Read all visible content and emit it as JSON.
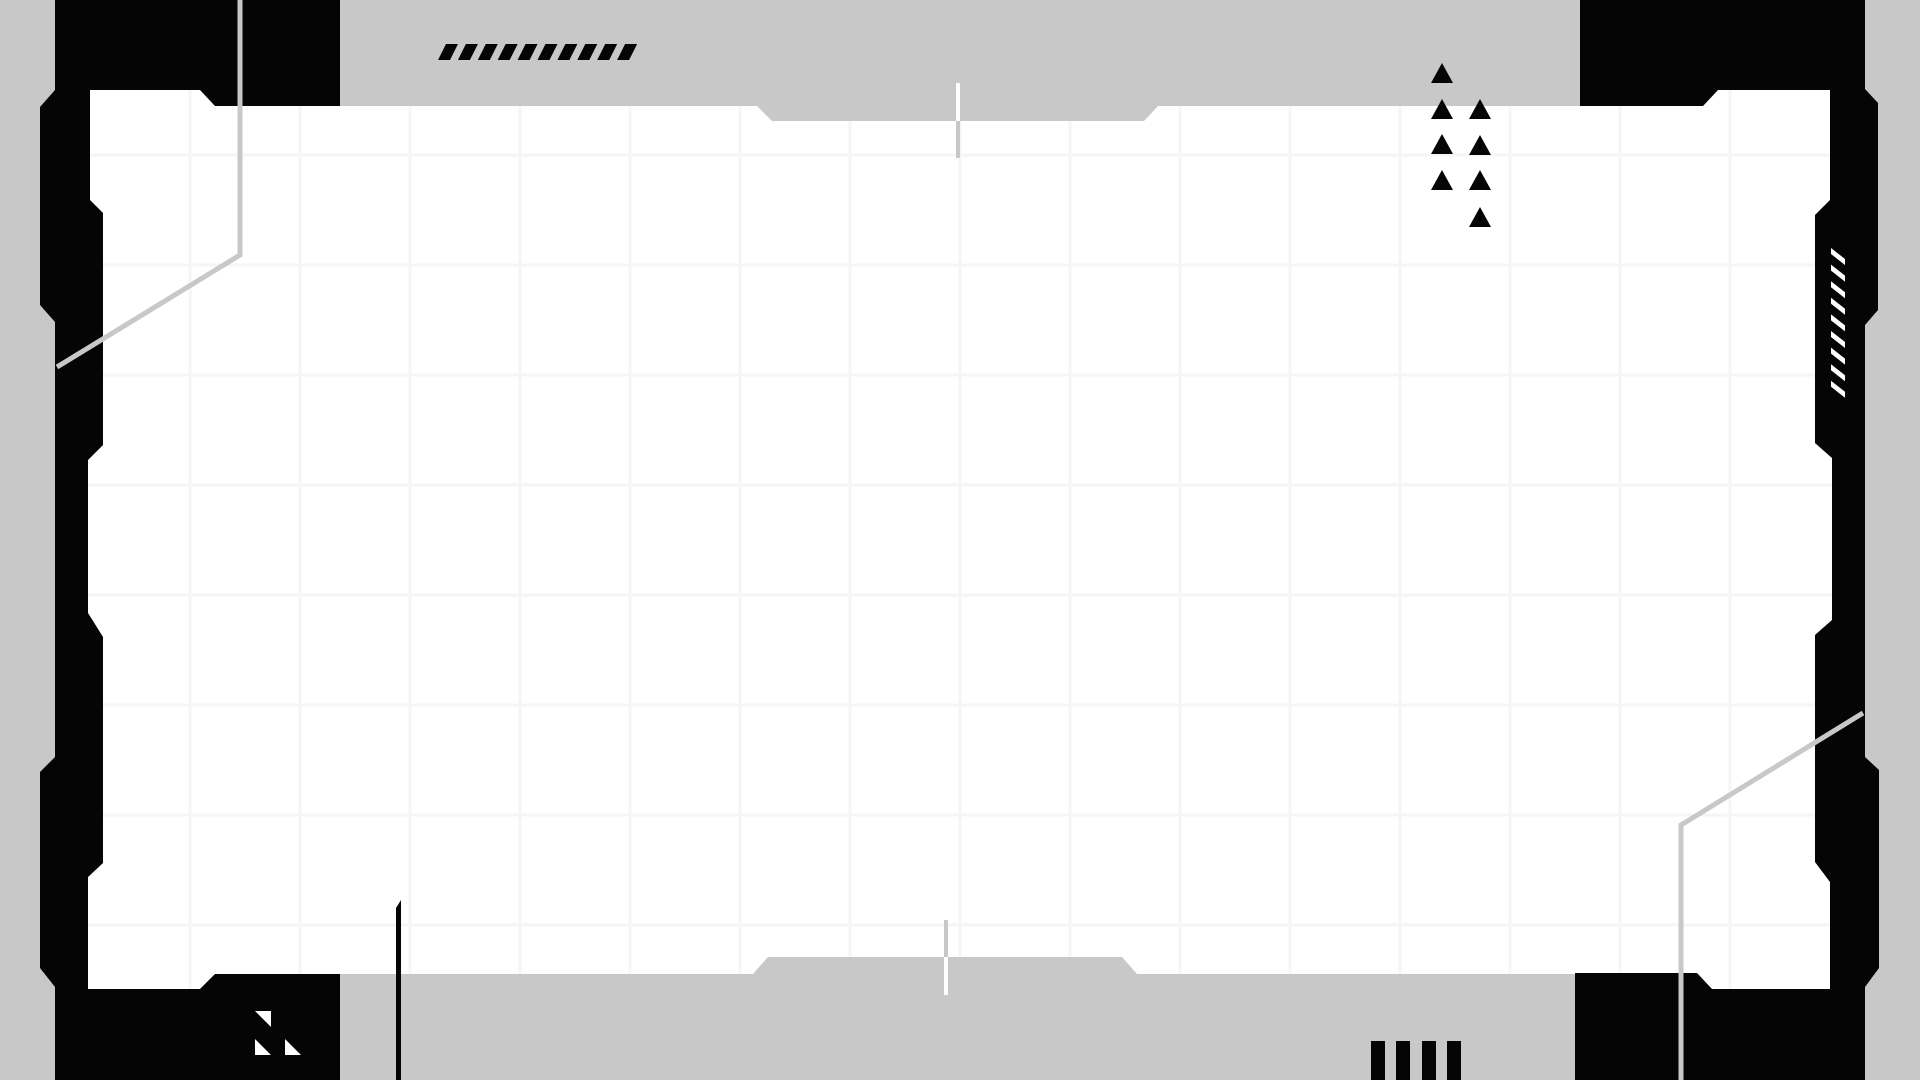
{
  "canvas": {
    "width": 1920,
    "height": 1080,
    "bg_color": "#c8c8c8",
    "panel_color": "#ffffff",
    "ink_color": "#050505",
    "grid_color": "#f5f5f5",
    "accent_line_color": "#c8c8c8"
  },
  "panel": {
    "outline": "90,90 200,90 215,106 757,106 772,121 1144,121 1158,106 1703,106 1718,90 1830,90 1830,200 1815,215 1815,443 1832,458 1832,620 1815,635 1815,862 1830,882 1830,989 1712,989 1697,974 1137,974 1122,957 768,957 753,974 215,974 200,989 88,989 88,877 103,863 103,637 88,613 88,460 103,445 103,213 90,200"
  },
  "grid": {
    "spacing": 110,
    "x_offset": 80,
    "y_offset": 45,
    "stroke_width": 3
  },
  "brackets": {
    "left": "55,0 340,0 340,106 215,106 200,90 90,90 90,200 103,213 103,445 88,460 88,613 103,637 103,863 88,877 88,989 200,989 215,974 340,974 340,1080 55,1080 55,987 40,968 40,772 55,757 55,322 40,305 40,107 55,90",
    "right": "1580,0 1865,0 1865,89 1878,103 1878,310 1865,325 1865,757 1879,770 1879,968 1865,987 1865,1080 1575,1080 1575,973 1697,973 1712,989 1830,989 1830,882 1815,862 1815,635 1832,620 1832,458 1815,443 1815,215 1830,200 1830,90 1718,90 1703,106 1580,106"
  },
  "decorations": {
    "top_slashes": {
      "count": 10,
      "x_start": 438,
      "pitch": 19.9,
      "y_top": 44,
      "y_bottom": 60,
      "slant": 8,
      "top_width": 12
    },
    "right_dashes": {
      "count": 9,
      "x": 1831,
      "width": 14,
      "y_start": 248,
      "pitch": 16.6,
      "drop": 11,
      "thickness": 6
    },
    "triangle_cluster": {
      "half_base": 11,
      "height": 20,
      "columns": [
        {
          "cx": 1442,
          "apex_ys": [
            63,
            99,
            134,
            170
          ]
        },
        {
          "cx": 1480,
          "apex_ys": [
            99,
            135,
            170,
            207
          ]
        }
      ]
    },
    "bottom_bars": {
      "xs": [
        1371,
        1396,
        1422,
        1447
      ],
      "width": 14,
      "y_top": 1041,
      "y_bottom": 1080
    },
    "corner_chips": [
      "255,1011 271,1011 271,1027",
      "255,1039 271,1055 255,1055",
      "285,1039 301,1055 285,1055"
    ],
    "vertical_line": {
      "points": "396,908 401,900 401,1080 396,1080"
    },
    "diagonal_lines": [
      {
        "points": "240,0 240,255 57,367"
      },
      {
        "points": "1681,1080 1681,825 1863,713"
      }
    ],
    "line_stroke_width": 5,
    "ticks": {
      "width": 4,
      "top": {
        "x": 956,
        "light_y1": 83,
        "light_y2": 121,
        "dark_y1": 121,
        "dark_y2": 158
      },
      "bottom": {
        "x": 944,
        "dark_y1": 920,
        "dark_y2": 957,
        "light_y1": 957,
        "light_y2": 995
      }
    }
  }
}
